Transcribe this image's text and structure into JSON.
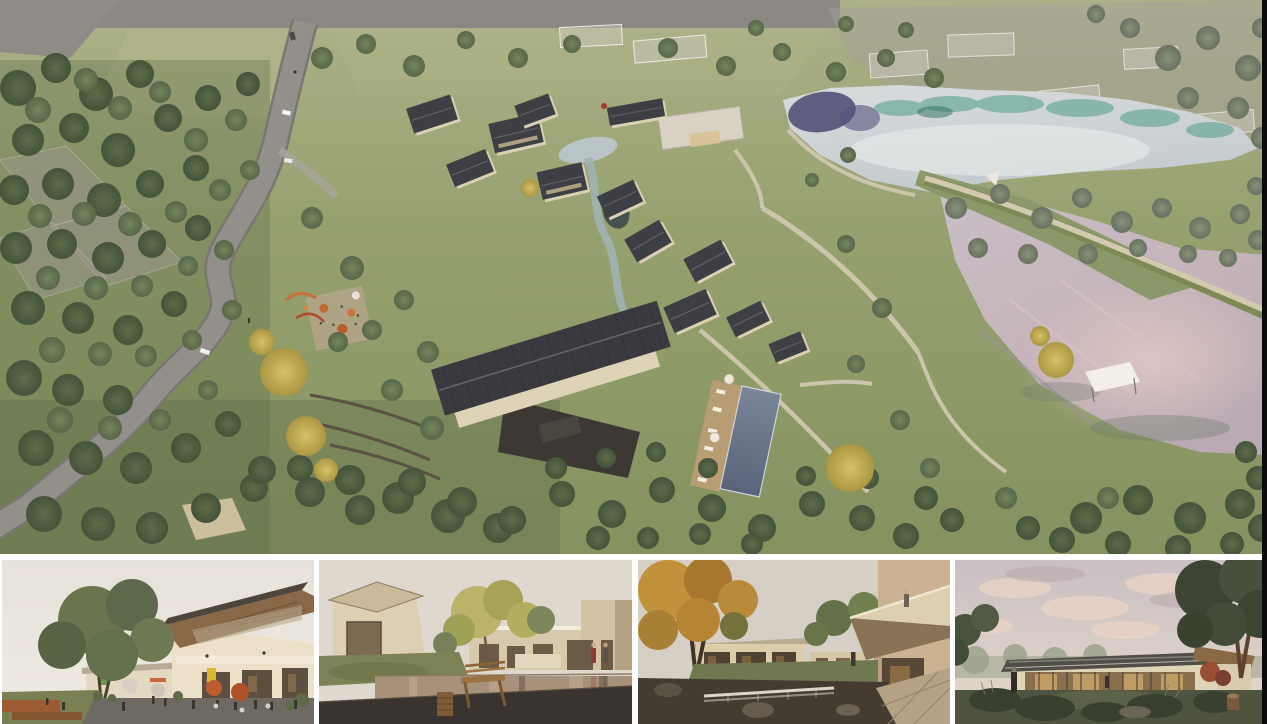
{
  "board": {
    "label": "Architectural rendering presentation board of a lakeside courtyard-village resort",
    "hero": {
      "label": "Aerial rendering: winding grey road through woodland on the left, cluster of dark gable-roof courtyard houses with stream, swimming pool and cafe terrace in the centre, silver-teal upper pond and large mauve lake with embankment walkway on the right, ghosted existing buildings at the top",
      "features": [
        "winding-road",
        "cars-on-road",
        "courtyard-village",
        "central-hall-ribbed-roof",
        "stream-and-ponds",
        "swimming-pool-with-deck",
        "cafe-terrace-orange-umbrellas",
        "playground",
        "shade-sail",
        "upper-pond-teal-reflections",
        "mauve-lake",
        "embankment-walkway",
        "white-sail-pavilion",
        "ghosted-existing-village",
        "yellow-autumn-trees"
      ]
    },
    "thumbnails": [
      {
        "label": "Street-level plaza view: two-storey building with slanted timber-soffit roof, cafe seating with orange umbrellas, large tree and rust planters"
      },
      {
        "label": "Courtyard reflecting pond: wooden bench and carved stool in foreground, beige houses, yellow-green tree, two visitors walking"
      },
      {
        "label": "Garden courtyard with weir pond: autumn tree, cantilevered balcony with onlooker, stone walk in foreground"
      },
      {
        "label": "Dusk view of single-storey glass pavilion with warm lit interior, pink clouds, large dark trees and meadow foreground"
      }
    ],
    "palette": {
      "grass_light": "#adb188",
      "grass_mid": "#97a170",
      "grass_dark": "#84925f",
      "tree_dark": "#4c5b3e",
      "tree_mid": "#6a7a53",
      "tree_yellow": "#c9b75a",
      "roof_dark": "#3e3e45",
      "wall_beige": "#ddd1b5",
      "road_grey": "#93908b",
      "upper_pond": "#cdd2d6",
      "pond_teal": "#4f9d8a",
      "pond_navy": "#43406a",
      "lake_mauve": "#c6b8c0",
      "lake_pink": "#e0c6c1",
      "pool_blue": "#667081",
      "ghost_grey": "#a49e97",
      "deck_tan": "#b89c74",
      "gap_white": "#ffffff",
      "edge_black": "#0b0b0b"
    }
  }
}
